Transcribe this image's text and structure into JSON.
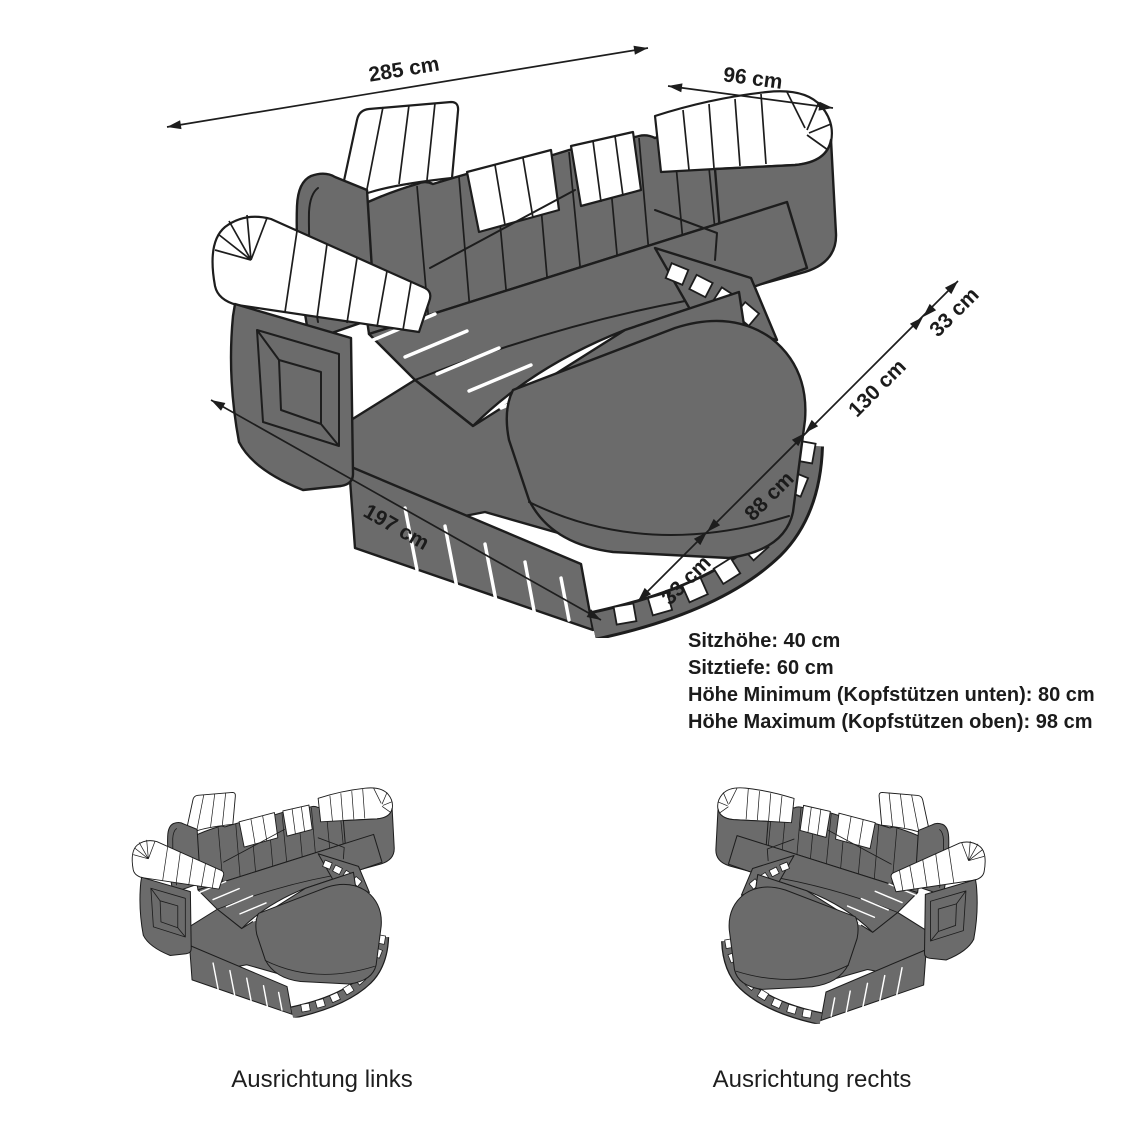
{
  "diagram": {
    "title_context": "Sofa dimension diagram",
    "dimensions": {
      "back_width": "285 cm",
      "arm_depth": "96 cm",
      "chaise_length": "197 cm",
      "side_segments": [
        "33 cm",
        "88 cm",
        "130 cm",
        "33 cm"
      ]
    },
    "specs": {
      "lines": [
        "Sitzhöhe: 40 cm",
        "Sitztiefe: 60 cm",
        "Höhe Minimum (Kopfstützen unten): 80 cm",
        "Höhe Maximum (Kopfstützen oben): 98 cm"
      ]
    },
    "variants": {
      "left_label": "Ausrichtung links",
      "right_label": "Ausrichtung rechts"
    },
    "icons": {
      "sofa_main": "l-shaped-sofa-isometric-drawing",
      "sofa_left_variant": "sofa-orientation-left-thumbnail",
      "sofa_right_variant": "sofa-orientation-right-thumbnail"
    },
    "colors": {
      "sofa_gray": "#6b6b6b",
      "outline": "#1d1d1d",
      "accent_white": "#ffffff",
      "text": "#1b1b1b",
      "background": "#ffffff"
    }
  }
}
